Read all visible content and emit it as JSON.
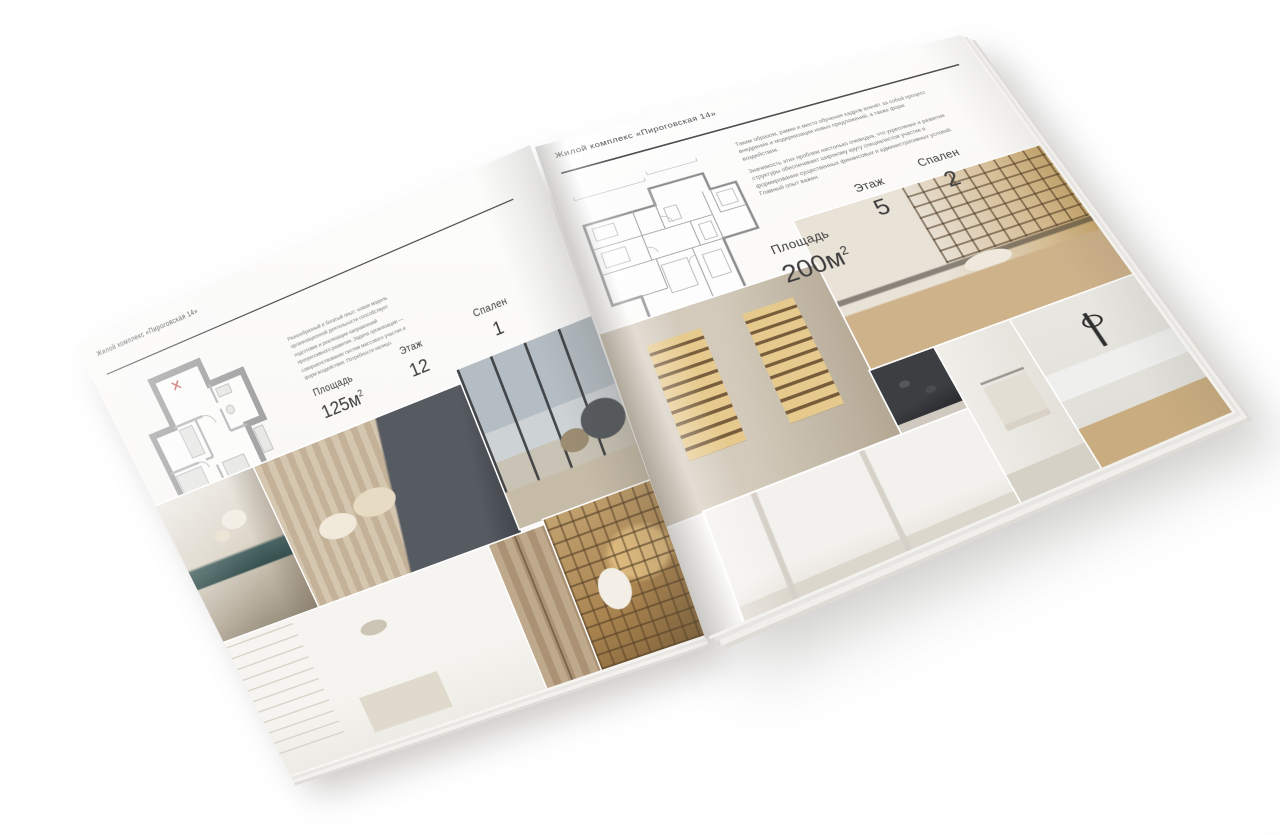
{
  "palette": {
    "page_white": "#fbfaf8",
    "text_dark": "#3d3d3d",
    "text_muted": "#7c7c7c",
    "plan_wall_gray": "#a5a5a5",
    "photo_warm_beige": "#c3b298",
    "photo_teal_accent": "#3e5c5a",
    "photo_wood": "#a9834f"
  },
  "brochure": {
    "left": {
      "header": "Жилой комплекс «Пироговская 14»",
      "description": "Разнообразный и богатый опыт: новая модель организационной деятельности способствует подготовке и реализации направлений прогрессивного развития. Задача организации — совершенствование систем массового участия и форм воздействия. Потребности налицо.",
      "stats": {
        "area_label": "Площадь",
        "area_value": "125м",
        "area_sup": "2",
        "floor_label": "Этаж",
        "floor_value": "12",
        "bedrooms_label": "Спален",
        "bedrooms_value": "1"
      },
      "photos": [
        "console-with-flowers",
        "master-bedroom",
        "living-room-panorama",
        "white-bedroom",
        "wood-corridor",
        "library-nook"
      ]
    },
    "right": {
      "header": "Жилой комплекс «Пироговская 14»",
      "description_1": "Таким образом, рамки и место обучения кадров влечёт за собой процесс внедрения и модернизации новых предложений, а также форм воздействия.",
      "description_2": "Значимость этих проблем настолько очевидна, что укрепление и развитие структуры обеспечивает широкому кругу специалистов участие в формировании существенных финансовых и административных условий. Главный опыт важен.",
      "stats": {
        "area_label": "Площадь",
        "area_value": "200м",
        "area_sup": "2",
        "floor_label": "Этаж",
        "floor_value": "5",
        "bedrooms_label": "Спален",
        "bedrooms_value": "2"
      },
      "photos": [
        "illuminated-cabinet",
        "home-office",
        "dark-cooktop",
        "white-hallway",
        "bathroom-towel-rail",
        "kitchen-counter"
      ]
    }
  }
}
